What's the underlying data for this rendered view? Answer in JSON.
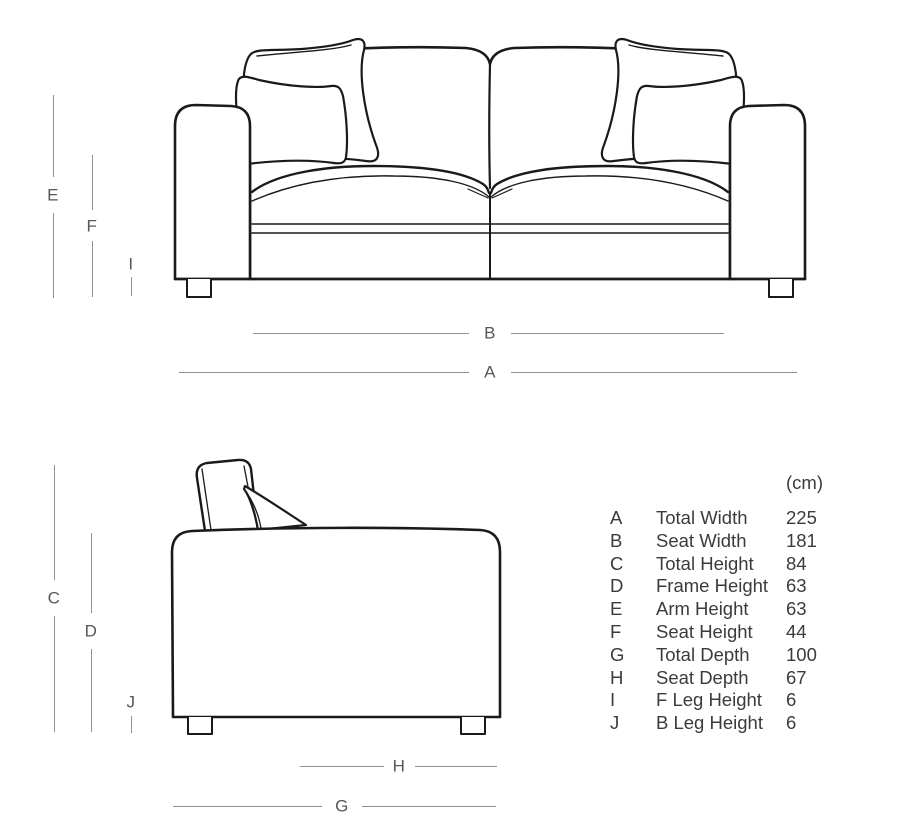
{
  "diagram": {
    "subject": "sofa-dimensions-diagram",
    "views": {
      "front_view": "sofa-front-elevation",
      "side_view": "sofa-side-elevation"
    }
  },
  "dimension_labels": {
    "A": "A",
    "B": "B",
    "C": "C",
    "D": "D",
    "E": "E",
    "F": "F",
    "G": "G",
    "H": "H",
    "I": "I",
    "J": "J"
  },
  "spec_table": {
    "unit_header": "(cm)",
    "rows": [
      {
        "key": "A",
        "label": "Total Width",
        "value": 225
      },
      {
        "key": "B",
        "label": "Seat Width",
        "value": 181
      },
      {
        "key": "C",
        "label": "Total Height",
        "value": 84
      },
      {
        "key": "D",
        "label": "Frame Height",
        "value": 63
      },
      {
        "key": "E",
        "label": "Arm Height",
        "value": 63
      },
      {
        "key": "F",
        "label": "Seat Height",
        "value": 44
      },
      {
        "key": "G",
        "label": "Total Depth",
        "value": 100
      },
      {
        "key": "H",
        "label": "Seat Depth",
        "value": 67
      },
      {
        "key": "I",
        "label": "F Leg Height",
        "value": 6
      },
      {
        "key": "J",
        "label": "B Leg Height",
        "value": 6
      }
    ]
  },
  "colors": {
    "drawing_line": "#1a1a1a",
    "dimension_line": "#8e9093",
    "dimension_label": "#55575a",
    "table_text": "#393b3e",
    "background": "#ffffff"
  }
}
